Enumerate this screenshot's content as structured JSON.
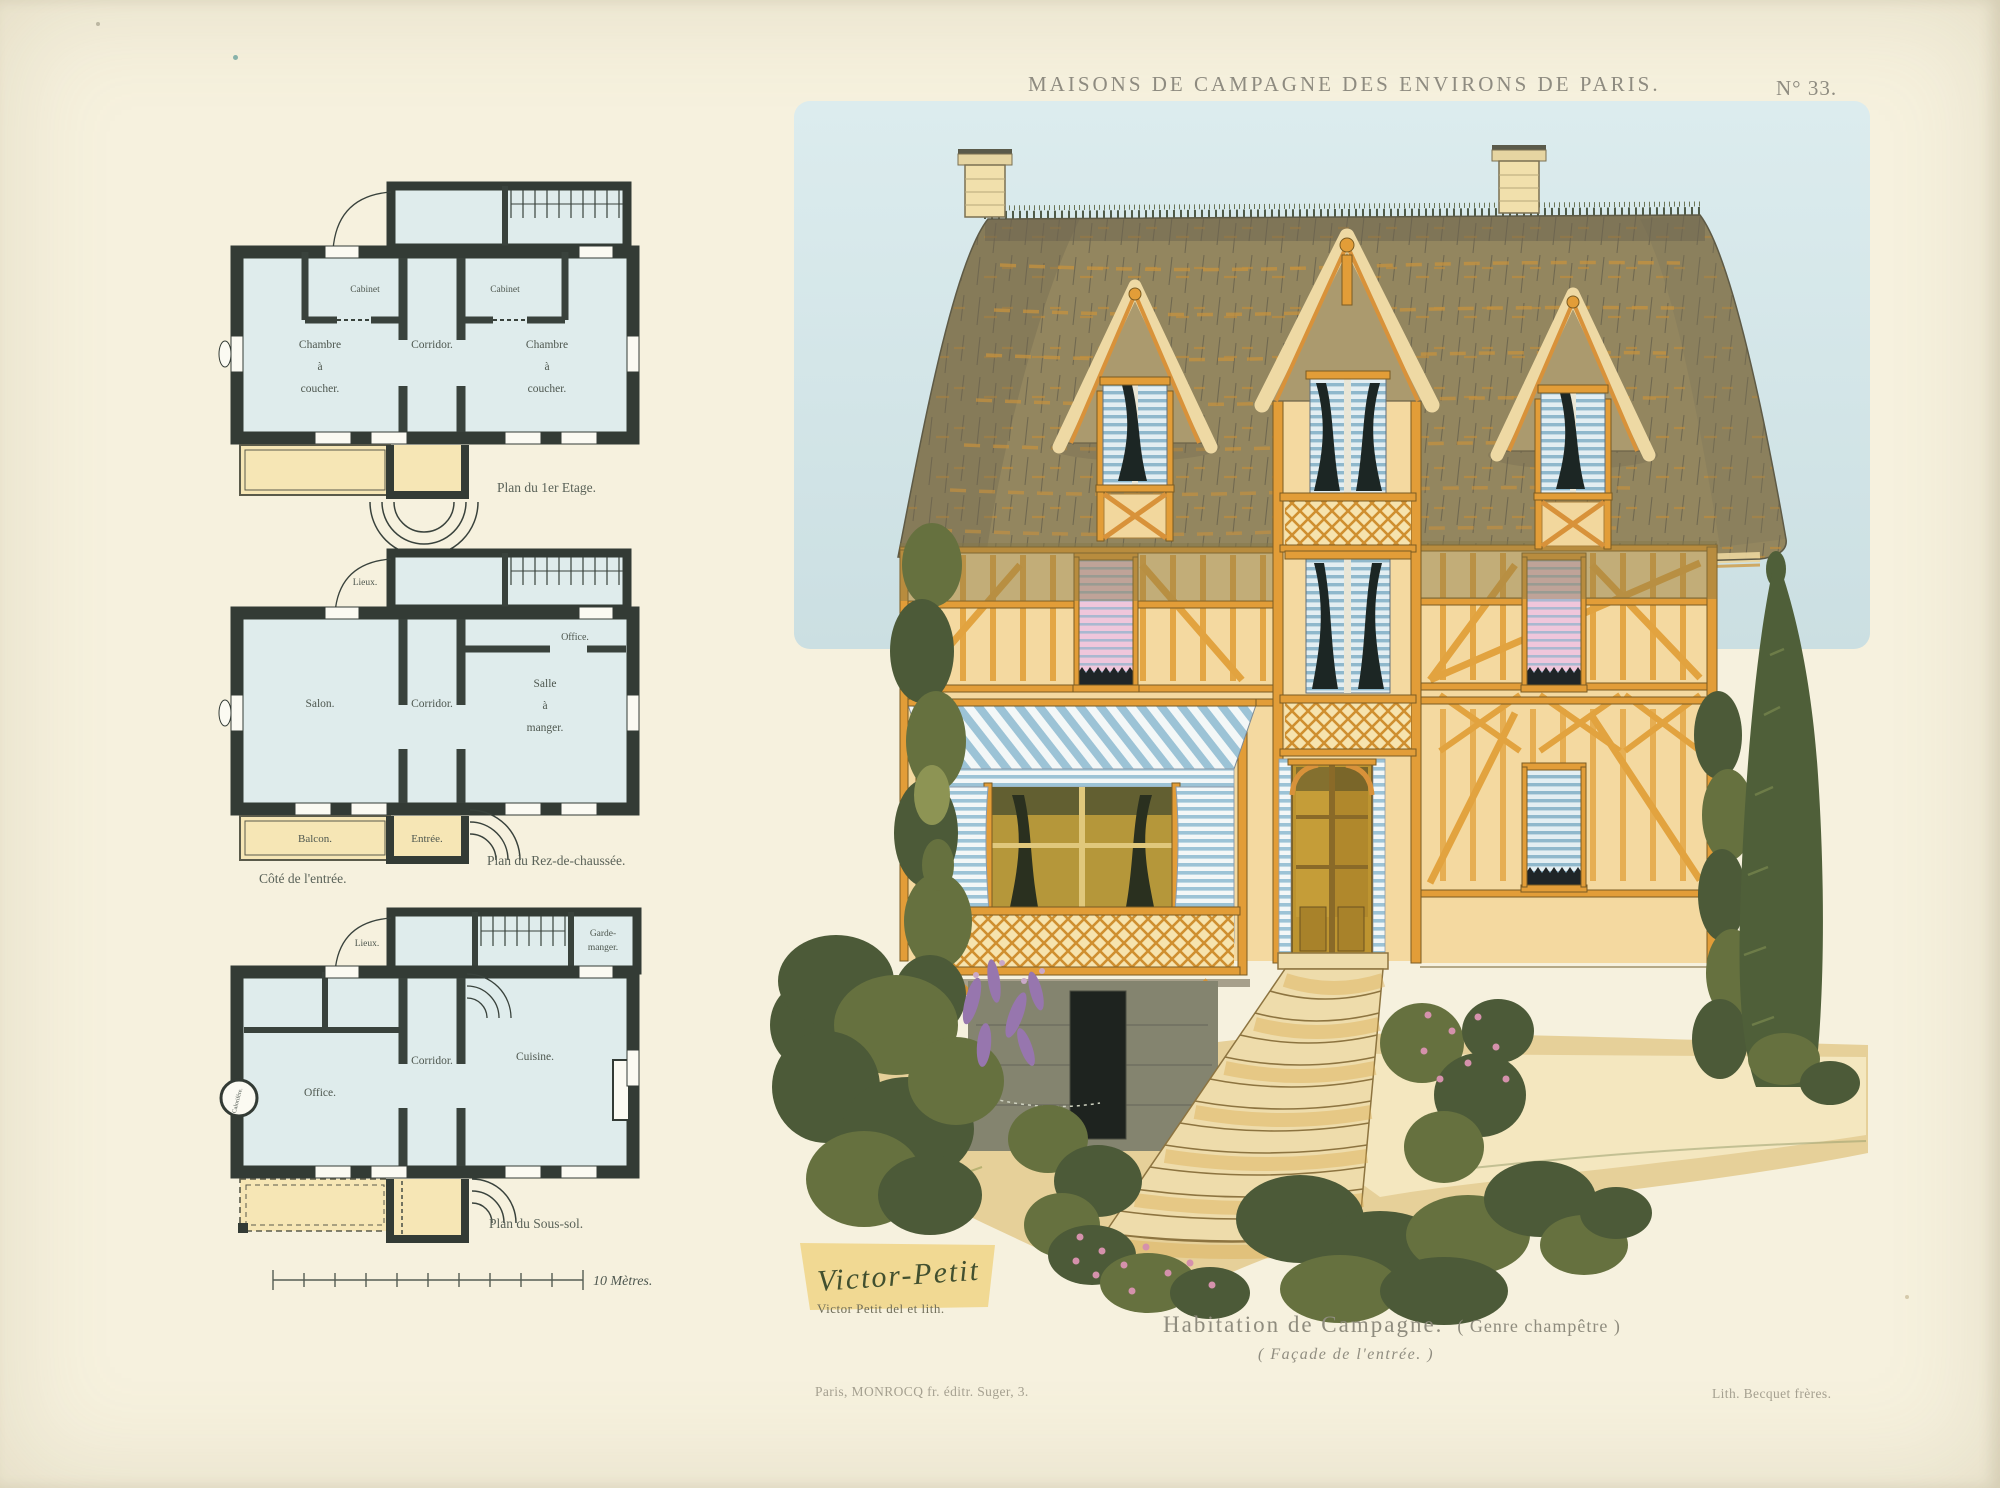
{
  "header": {
    "title": "MAISONS DE CAMPAGNE DES ENVIRONS DE PARIS.",
    "plate_number": "N° 33."
  },
  "plans": {
    "etage": {
      "caption": "Plan du 1er Etage.",
      "cabinet": "Cabinet",
      "chambre": [
        "Chambre",
        "à",
        "coucher."
      ],
      "corridor": "Corridor."
    },
    "rdc": {
      "caption": "Plan du Rez-de-chaussée.",
      "cote": "Côté de l'entrée.",
      "lieux": "Lieux.",
      "office": "Office.",
      "salon": "Salon.",
      "corridor": "Corridor.",
      "salle": [
        "Salle",
        "à",
        "manger."
      ],
      "balcon": "Balcon.",
      "entree": "Entrée."
    },
    "soussol": {
      "caption": "Plan du Sous-sol.",
      "lieux": "Lieux.",
      "garde": [
        "Garde-",
        "manger."
      ],
      "office": "Office.",
      "corridor": "Corridor.",
      "cuisine": "Cuisine.",
      "calorifere": "Calorifère."
    },
    "scale_label": "10 Mètres."
  },
  "facade": {
    "signature": "Victor-Petit",
    "credit": "Victor Petit del et lith."
  },
  "captions": {
    "main": "Habitation de Campagne.",
    "genre": "( Genre champêtre )",
    "sub": "( Façade de l'entrée. )"
  },
  "footer": {
    "publisher": "Paris, MONROCQ fr. éditr. Suger, 3.",
    "lithographer": "Lith. Becquet frères."
  },
  "colors": {
    "paper": "#f6f1de",
    "ink": "#8e8b80",
    "sky": "#d7e8ea",
    "roof": "#93865f",
    "timber": "#e29d38",
    "wall": "#f4d9a0",
    "awning_blue": "#9cc3d6",
    "shade_pink": "#e9aecb",
    "door_amber": "#bd9430",
    "ground_sand": "#e6d099",
    "fol_d": "#4c5a38",
    "fol_m": "#66713f",
    "fol_l": "#8d9454",
    "planwall": "#333b35",
    "planroom": "#dfecec",
    "balcony_yellow": "#f6e6b5",
    "plantext": "#4e574f"
  }
}
